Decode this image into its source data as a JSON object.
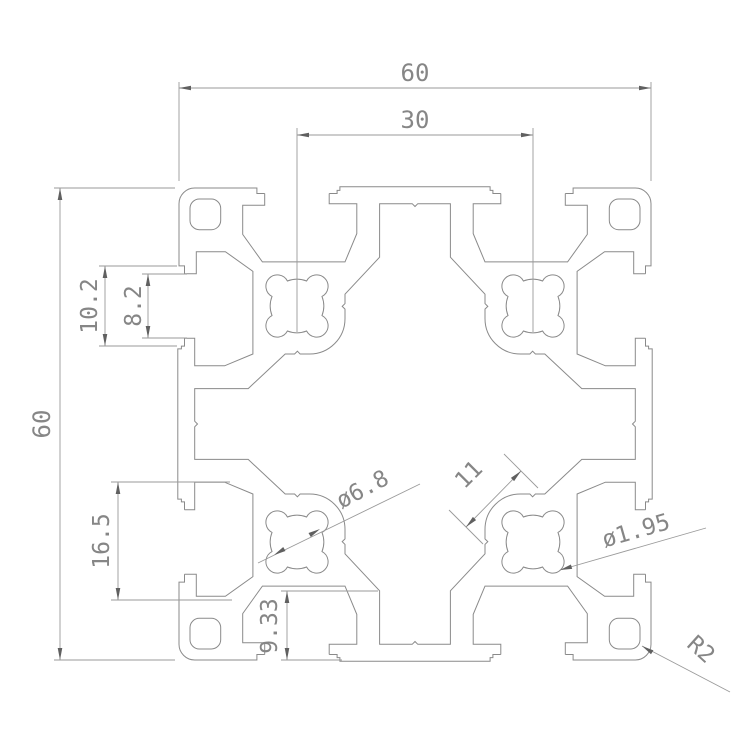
{
  "colors": {
    "background": "#ffffff",
    "profile_line": "#8a8a8a",
    "dim_line": "#9a9a9a",
    "arrow": "#606060",
    "text": "#868686"
  },
  "dimensions": {
    "overall_width": "60",
    "slot_pitch": "30",
    "overall_height": "60",
    "slot_outer_width": "10.2",
    "slot_opening_width": "8.2",
    "side_pocket_width": "16.5",
    "bottom_wall": "9.33",
    "core_hole_dia": "ø6.8",
    "boss_width": "11",
    "pilot_hole_dia": "ø1.95",
    "corner_radius": "R2"
  }
}
